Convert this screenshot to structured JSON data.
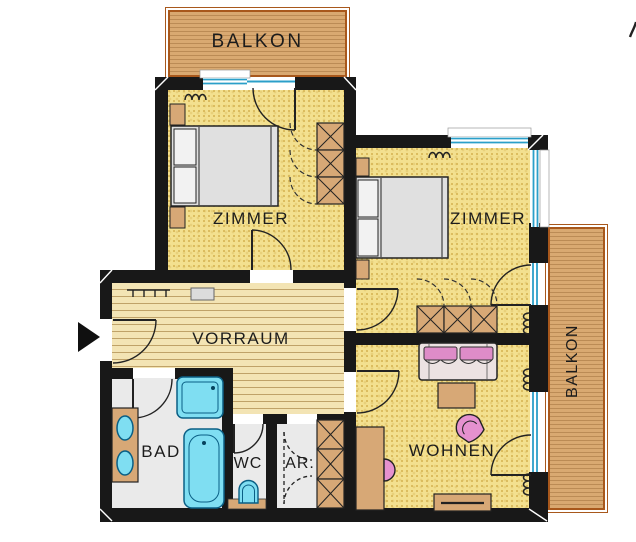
{
  "labels": {
    "balcony_top": "BALKON",
    "bedroom_left": "ZIMMER",
    "bedroom_right": "ZIMMER",
    "hallway": "VORRAUM",
    "bathroom": "BAD",
    "wc": "WC",
    "storage": "AR.",
    "living_room": "WOHNEN",
    "balcony_right": "BALKON"
  },
  "icons": {
    "entrance_arrow": "right-pointing-triangle"
  },
  "colors": {
    "wall": "#181818",
    "room_floor_yellow": "#f3e08f",
    "hall_wood": "#f3e4b4",
    "balcony_wood": "#d9a971",
    "balcony_border": "#a8581c",
    "bath_tile": "#eaeaea",
    "glass_blue": "#2b9fc9",
    "fixture_cyan": "#7fdef2",
    "furniture_tan": "#d7a876",
    "accent_pink": "#e591cf",
    "bed_gray": "#e0e0e0"
  }
}
